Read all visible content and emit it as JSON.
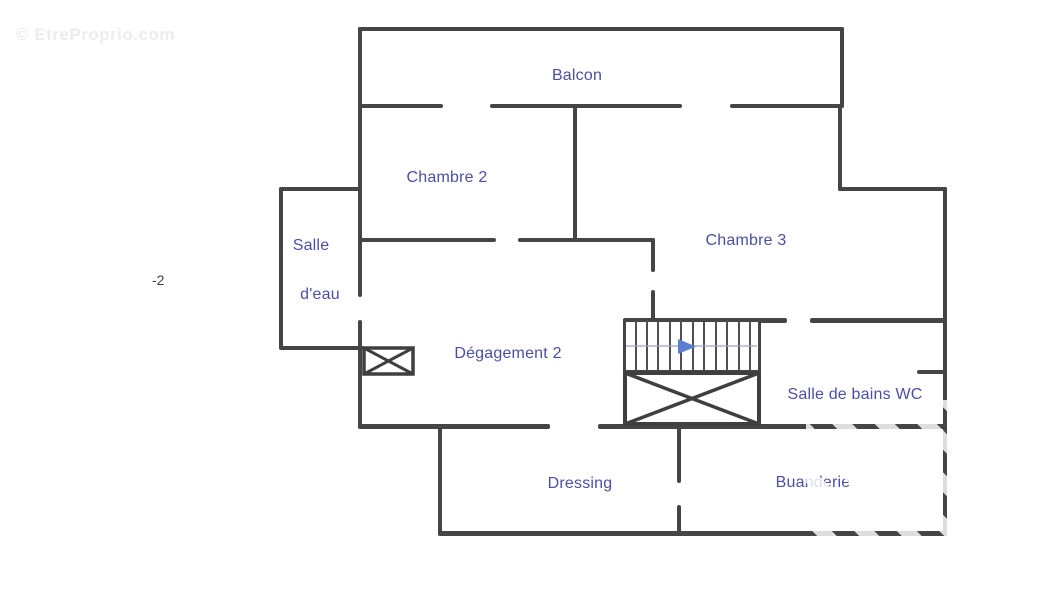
{
  "watermark": {
    "text": "© EtreProprio.com"
  },
  "level_label": "-2",
  "rooms": {
    "balcon": "Balcon",
    "chambre2": "Chambre 2",
    "chambre3": "Chambre 3",
    "salle_deau_line1": "Salle",
    "salle_deau_line2": "d'eau",
    "degagement": "Dégagement 2",
    "salle_de_bains": "Salle de bains WC",
    "dressing": "Dressing",
    "buanderie": "Buanderie"
  },
  "stairs": {
    "direction_arrow": "right",
    "tread_count": 12
  },
  "colors": {
    "wall": "#454545",
    "room_label": "#4a4fa5",
    "stair_arrow": "#5b7fd0",
    "watermark": "#ececec",
    "level_text": "#3f3f3f"
  }
}
